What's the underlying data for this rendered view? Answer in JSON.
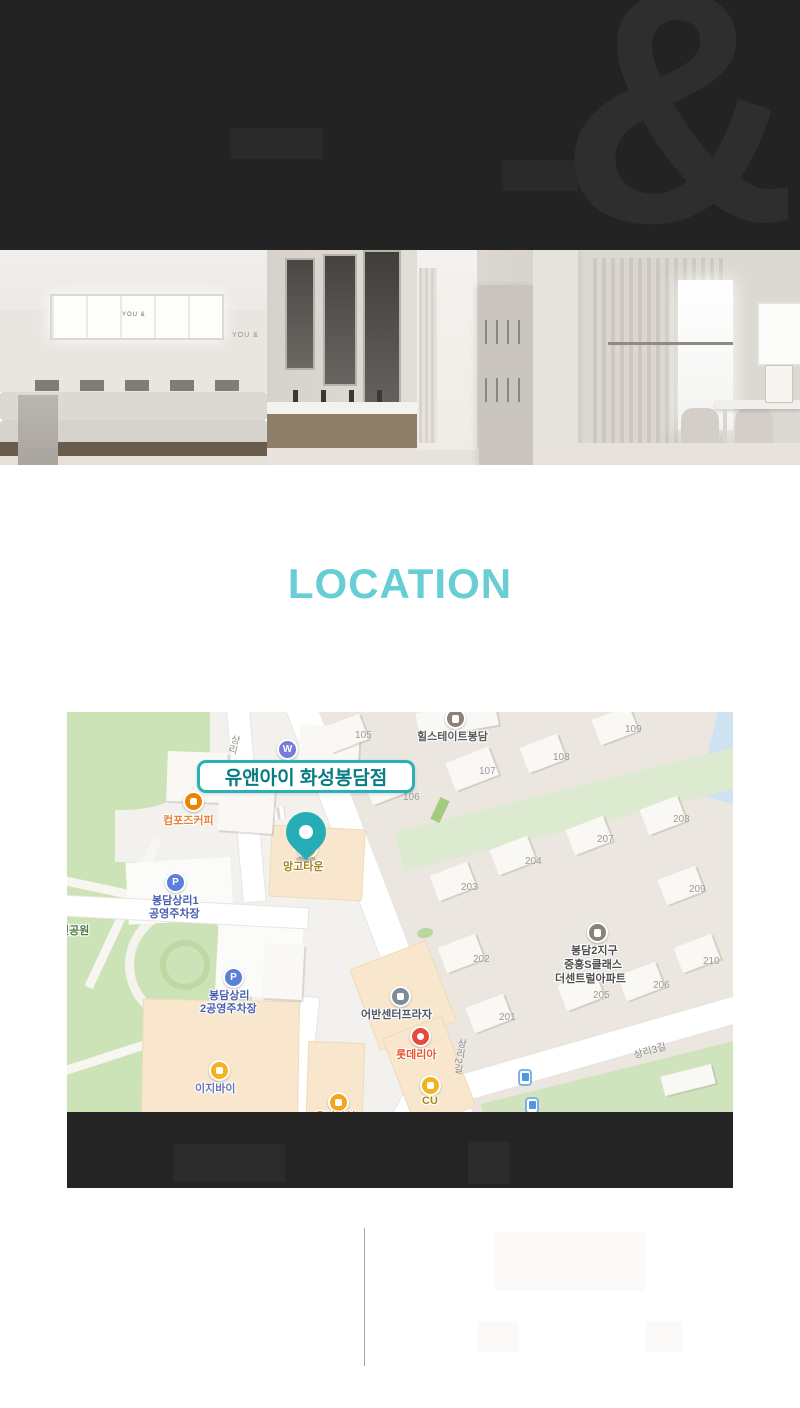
{
  "header": {
    "ampersand": "&"
  },
  "gallery": {
    "sign_text": "YOU &"
  },
  "location": {
    "title": "LOCATION"
  },
  "map": {
    "badge": "유앤아이 화성봉담점",
    "pois": {
      "w": {
        "label": "W"
      },
      "compose": {
        "label": "컴포즈커피"
      },
      "mango": {
        "label": "망고타운"
      },
      "parking1": {
        "line1": "봉담상리1",
        "line2": "공영주차장"
      },
      "parking2": {
        "line1": "봉담상리",
        "line2": "2공영주차장"
      },
      "park": {
        "label": "민공원"
      },
      "easyby": {
        "label": "이지바이"
      },
      "urban": {
        "label": "어반센터프라자"
      },
      "lotteria": {
        "label": "롯데리아"
      },
      "cu": {
        "label": "CU"
      },
      "organic": {
        "label": "유기본연"
      },
      "hillstate": {
        "label": "힐스테이트봉담"
      },
      "jungheung": {
        "line1": "봉담2지구",
        "line2": "중흥S클래스",
        "line3": "더센트럴아파트"
      },
      "parking_icon_letter": "P"
    },
    "streets": {
      "sangri": "상리",
      "sangri2": "상리2길",
      "sangri3": "상리3길"
    },
    "numbers": [
      "105",
      "106",
      "107",
      "108",
      "109",
      "201",
      "202",
      "203",
      "204",
      "205",
      "206",
      "207",
      "208",
      "209",
      "210"
    ]
  },
  "palette": {
    "accent_teal": "#29b1b9",
    "title_teal": "#68ced6",
    "pin_teal": "#26acb4",
    "header_bg": "#232323",
    "band_bg": "#242424",
    "map_park_green": "#cbe3b7",
    "map_beige_block": "#f8e7cc"
  }
}
